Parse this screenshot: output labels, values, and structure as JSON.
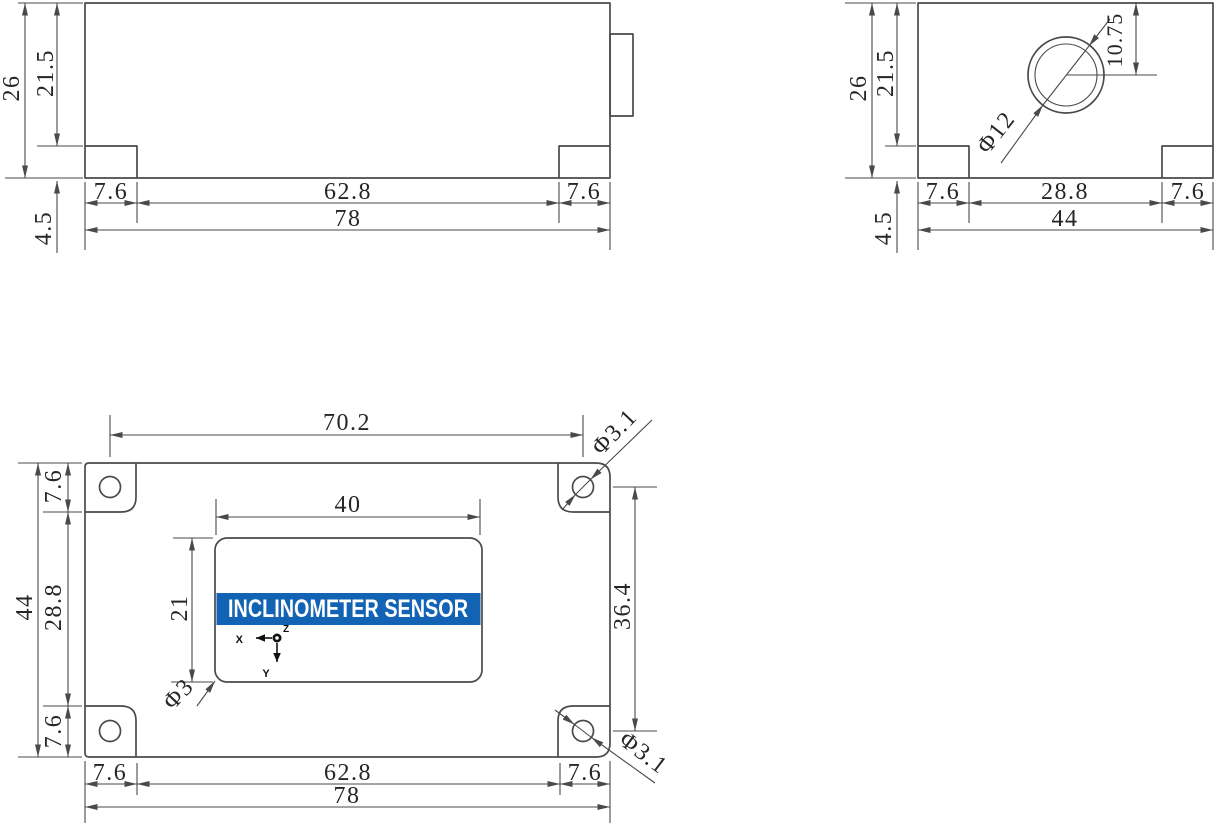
{
  "drawing": {
    "colors": {
      "line": "#4a4a4a",
      "text": "#262626",
      "banner_bg": "#1263b3",
      "banner_text": "#ffffff"
    },
    "front": {
      "h_total": "26",
      "h_upper": "21.5",
      "h_flange": "4.5",
      "w_step_l": "7.6",
      "w_mid": "62.8",
      "w_step_r": "7.6",
      "w_total": "78"
    },
    "side": {
      "h_total": "26",
      "h_upper": "21.5",
      "h_flange": "4.5",
      "w_step_l": "7.6",
      "w_mid": "28.8",
      "w_step_r": "7.6",
      "w_total": "44",
      "connector_dia": "Φ12",
      "connector_depth": "10.75"
    },
    "top": {
      "hole_pitch_x": "70.2",
      "hole_pitch_y": "36.4",
      "corner_offset_top": "7.6",
      "h_mid": "28.8",
      "h_total": "44",
      "corner_offset_bottom": "7.6",
      "label_w": "40",
      "label_h": "21",
      "label_corner_dia": "Φ3",
      "hole_dia_tr": "Φ3.1",
      "hole_dia_br": "Φ3.1",
      "w_step_l": "7.6",
      "w_mid": "62.8",
      "w_step_r": "7.6",
      "w_total": "78",
      "label_text": "INCLINOMETER SENSOR",
      "axis_x": "X",
      "axis_y": "Y",
      "axis_z": "Z"
    }
  }
}
